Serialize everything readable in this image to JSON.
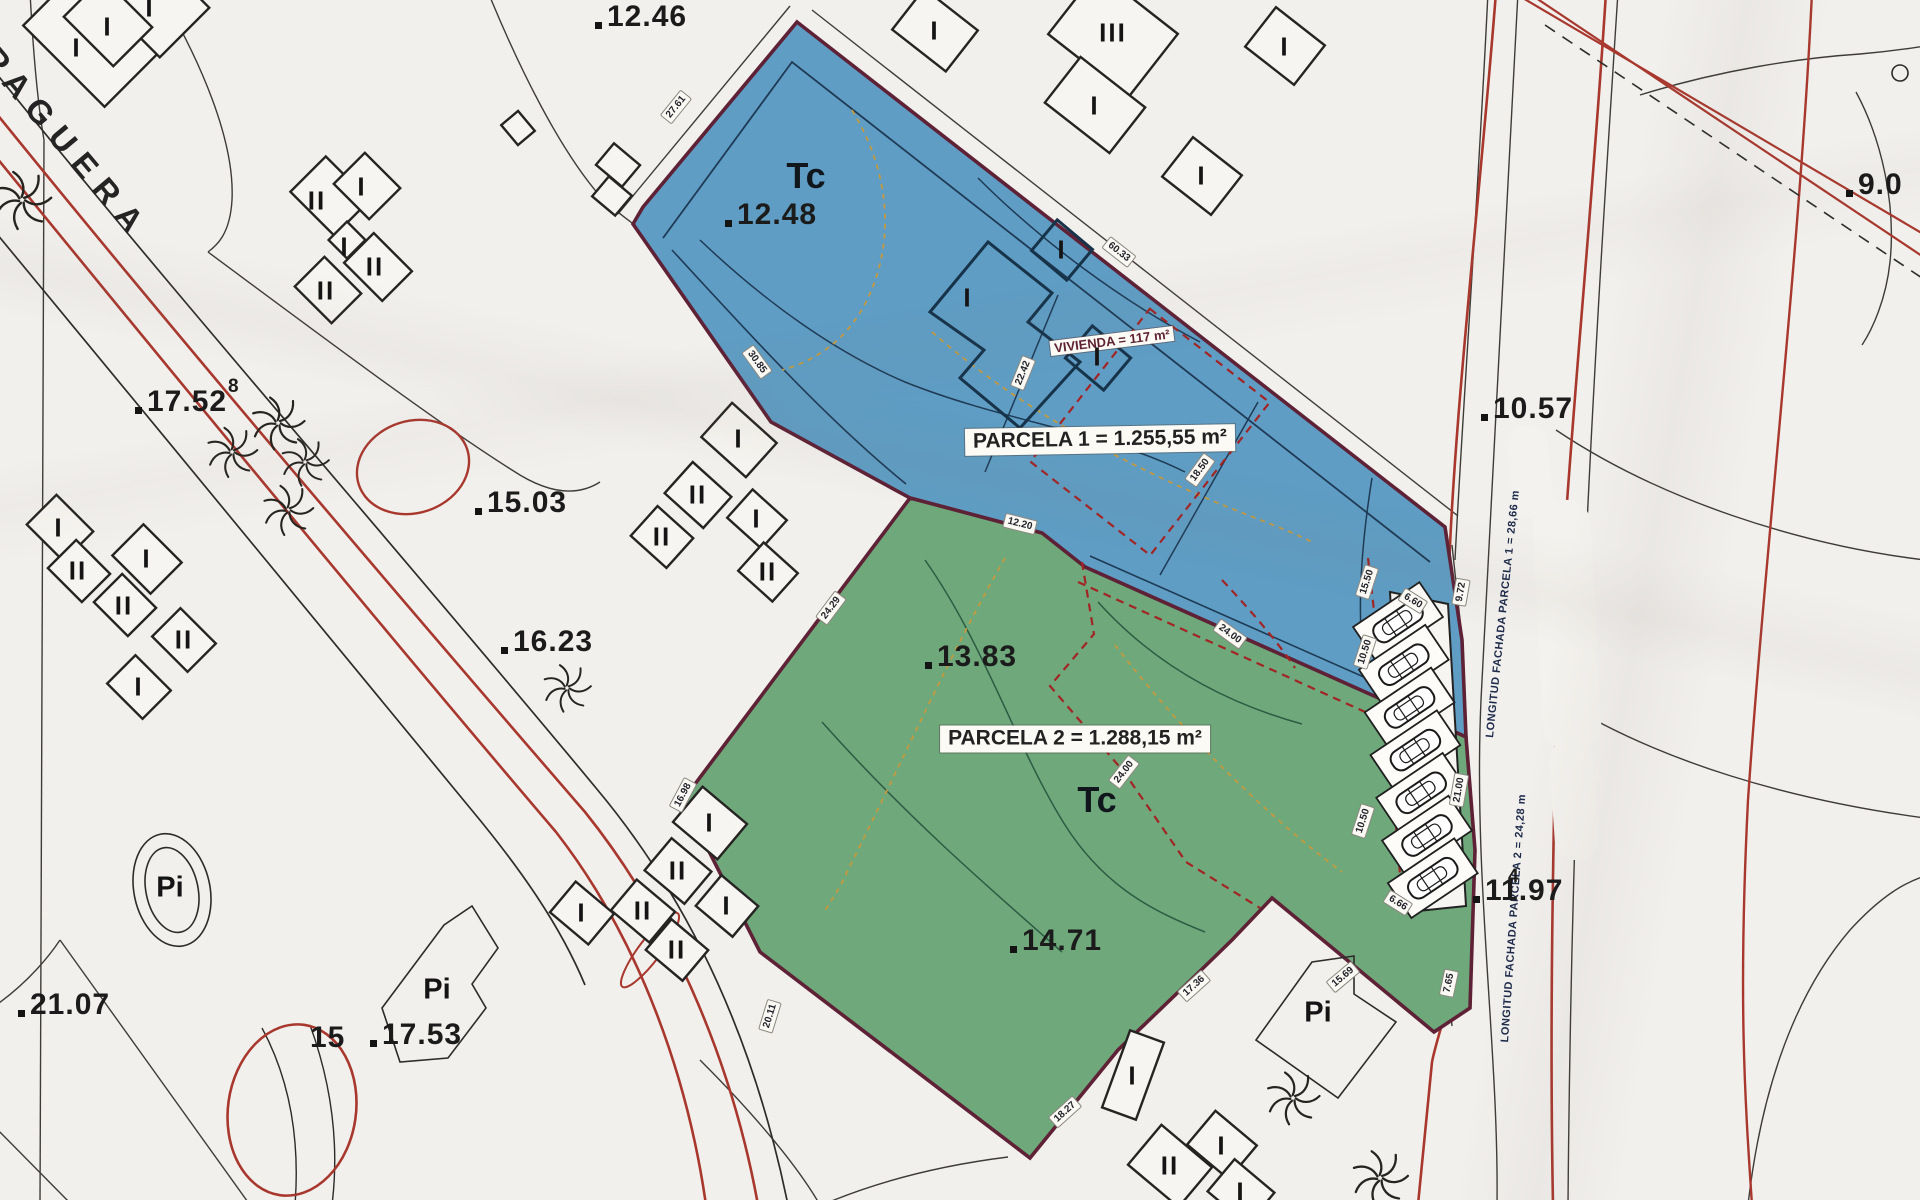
{
  "street": {
    "name": "PAGUERA"
  },
  "parcels": [
    {
      "id": "parcela-1",
      "land_use_code": "Tc",
      "area_label": "PARCELA 1 = 1.255,55 m²",
      "frontage_label": "LONGITUD FACHADA PARCELA 1 = 28,66 m",
      "fill_color": "#5f9dc4",
      "boundary_color": "#5e2136"
    },
    {
      "id": "parcela-2",
      "land_use_code": "Tc",
      "area_label": "PARCELA 2 = 1.288,15 m²",
      "frontage_label": "LONGITUD FACHADA PARCELA 2 = 24,28 m",
      "fill_color": "#6ea87b",
      "boundary_color": "#5e2136"
    }
  ],
  "building_area_note": "VIVIENDA = 117 m²",
  "vegetation_label": "Pi",
  "spot_elevations": [
    {
      "value": "12.46"
    },
    {
      "value": "12.48"
    },
    {
      "value": "17.52",
      "sup": "8"
    },
    {
      "value": "15.03"
    },
    {
      "value": "16.23"
    },
    {
      "value": "21.07"
    },
    {
      "value": "10.57"
    },
    {
      "value": "9.0"
    },
    {
      "value": "13.83"
    },
    {
      "value": "14.71"
    },
    {
      "value": "11.97",
      "sup": "4"
    },
    {
      "value": "17.53"
    },
    {
      "value": "15"
    }
  ],
  "edge_measurements": [
    "27.61",
    "60.33",
    "30.85",
    "22.42",
    "18.50",
    "15.50",
    "24.00",
    "24.00",
    "12.20",
    "24.29",
    "16.98",
    "20.11",
    "18.27",
    "17.36",
    "15.69",
    "7.65",
    "9.72",
    "21.00",
    "6.60",
    "6.66",
    "10.50",
    "10.50"
  ],
  "floor_marks": [
    "I",
    "I",
    "I",
    "II",
    "I",
    "I",
    "II",
    "II",
    "I",
    "II",
    "I",
    "II",
    "II",
    "I",
    "I",
    "II",
    "II",
    "I",
    "II",
    "I",
    "II",
    "I",
    "II",
    "I",
    "II",
    "II",
    "I",
    "I",
    "I",
    "III",
    "I",
    "I",
    "I",
    "I",
    "I",
    "I",
    "I"
  ],
  "colors": {
    "paper": "#f2f0ed",
    "road_red": "#a8382e",
    "dashed_red": "#a32424",
    "navy": "#1e3a55",
    "line_black": "#2e2c2a",
    "orange_dash": "#c49a3f",
    "green_contour": "#2d5b43"
  }
}
